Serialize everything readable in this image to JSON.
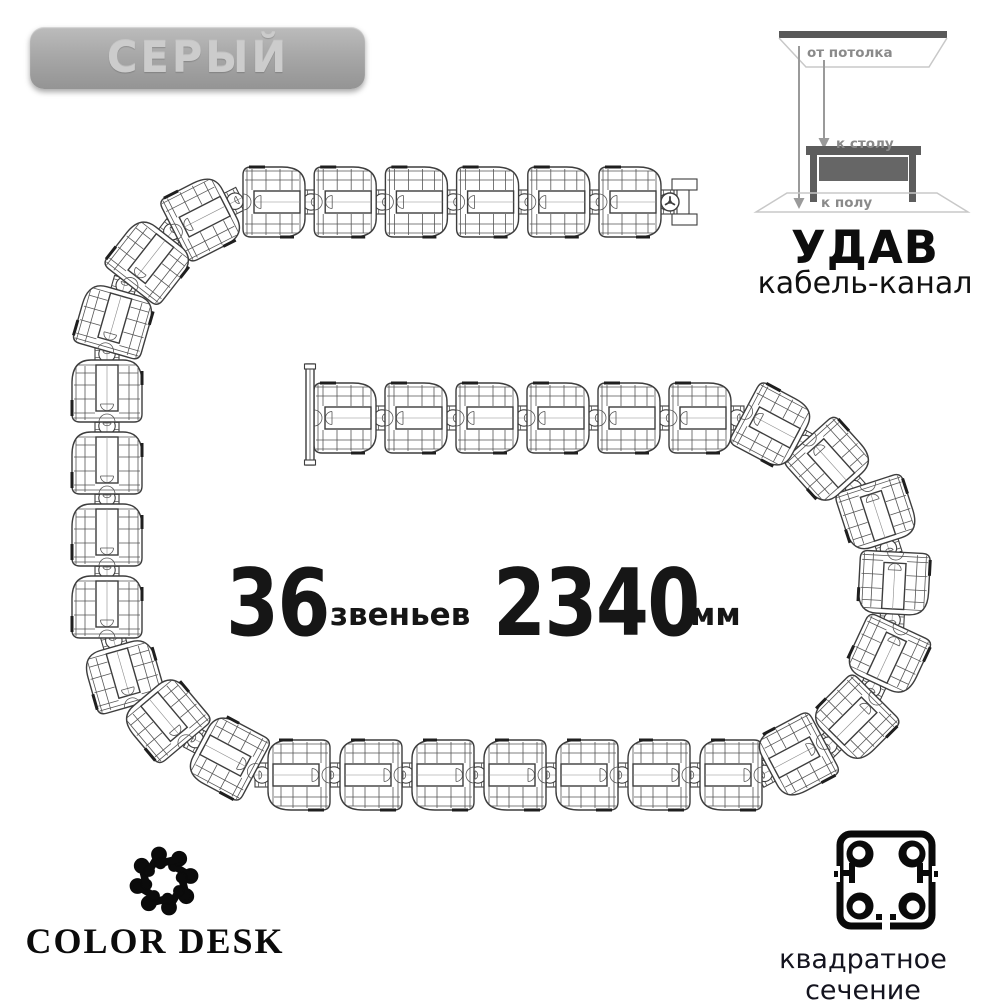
{
  "badge": {
    "label": "СЕРЫЙ",
    "color_hex": "#a8a8a8"
  },
  "diagram": {
    "from_ceiling": "от потолка",
    "to_desk": "к столу",
    "to_floor": "к полу",
    "label_color": "#8a8a8a"
  },
  "product": {
    "name": "УДАВ",
    "subtitle": "кабель-канал"
  },
  "specs": {
    "links_value": "36",
    "links_label": "звеньев",
    "length_value": "2340",
    "length_unit": "мм"
  },
  "brand": {
    "name": "COLOR DESK"
  },
  "cross_section": {
    "label": "квадратное сечение"
  },
  "colors": {
    "line_art": "#3d3d3d",
    "text_dark": "#161616",
    "background": "#ffffff"
  }
}
